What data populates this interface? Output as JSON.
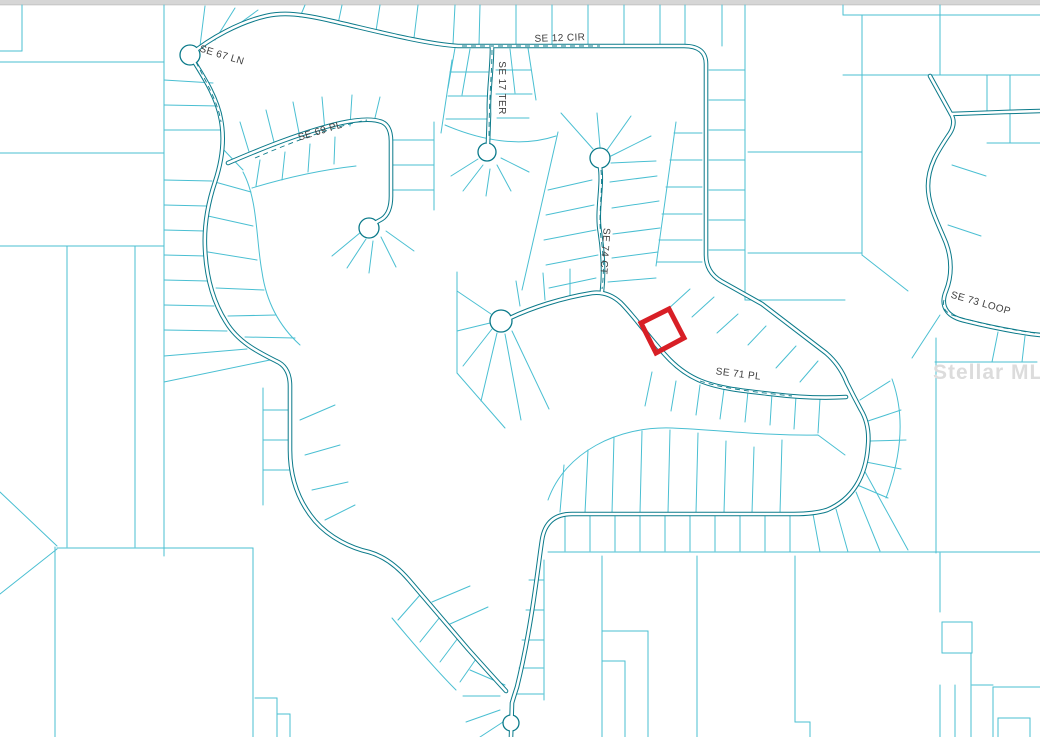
{
  "map": {
    "description": "County plat / parcel map with subject lot outlined in red",
    "top_bar_color": "#d6d6d6",
    "background_color": "#ffffff",
    "parcel_line_color": "#4abfd2",
    "road_line_color": "#0b7a8a",
    "label_color": "#3e3e3e",
    "street_labels": [
      {
        "text": "SE 12 CIR"
      },
      {
        "text": "SE 67 LN"
      },
      {
        "text": "SE 69 PL"
      },
      {
        "text": "SE 17 TER"
      },
      {
        "text": "SE 74 CT"
      },
      {
        "text": "SE 71 PL"
      },
      {
        "text": "SE 73 LOOP"
      }
    ],
    "watermark": {
      "text": "Stellar MLS",
      "color": "#dcdcdc"
    },
    "highlighted_parcel": {
      "name": "subject-parcel",
      "outline_color": "#d81f26"
    }
  }
}
